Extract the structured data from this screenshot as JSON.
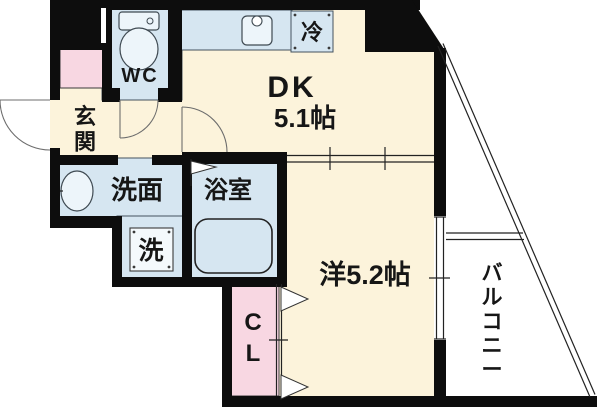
{
  "floorplan": {
    "labels": {
      "dk_line1": "DK",
      "dk_line2": "5.1帖",
      "western_room": "洋5.2帖",
      "entrance": "玄関",
      "toilet": "WC",
      "washroom": "洗面",
      "bathroom": "浴室",
      "washer": "洗",
      "fridge": "冷",
      "closet": "CL",
      "balcony": "バルコニー"
    },
    "colors": {
      "floor_cream": "#FCF3DB",
      "wet_area_blue": "#D6E6F1",
      "accent_pink": "#F8D7E2",
      "wall_black": "#0D0D0D",
      "background": "#FFFFFF",
      "fixture_light": "#EDF5FA"
    }
  }
}
